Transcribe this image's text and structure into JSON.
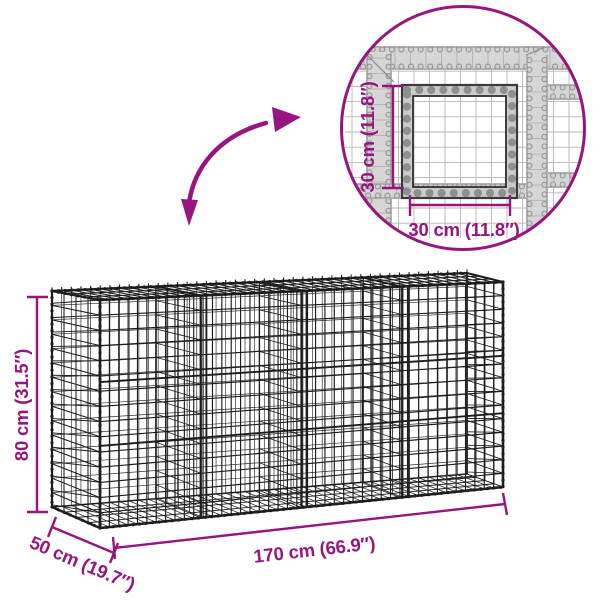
{
  "colors": {
    "accent": "#97157F",
    "wire": "#1d1d1d",
    "inset_band_fill": "#d6d6d6",
    "inset_band_edge": "#8a8a8a",
    "inset_band_dot_dark": "#8f8f8f",
    "inset_band_dot_light": "#cfcfcf",
    "inset_frame": "#3a3a3a",
    "inset_grid": "#b6b6b6"
  },
  "icons": {
    "zoom_arrow_icon": "curved-double-arrow"
  },
  "basket": {
    "height_label": "80 cm (31.5″)",
    "width_label": "170 cm (66.9″)",
    "depth_label": "50 cm (19.7″)"
  },
  "detail_inset": {
    "height_label": "30 cm (11.8″)",
    "width_label": "30 cm (11.8″)"
  }
}
